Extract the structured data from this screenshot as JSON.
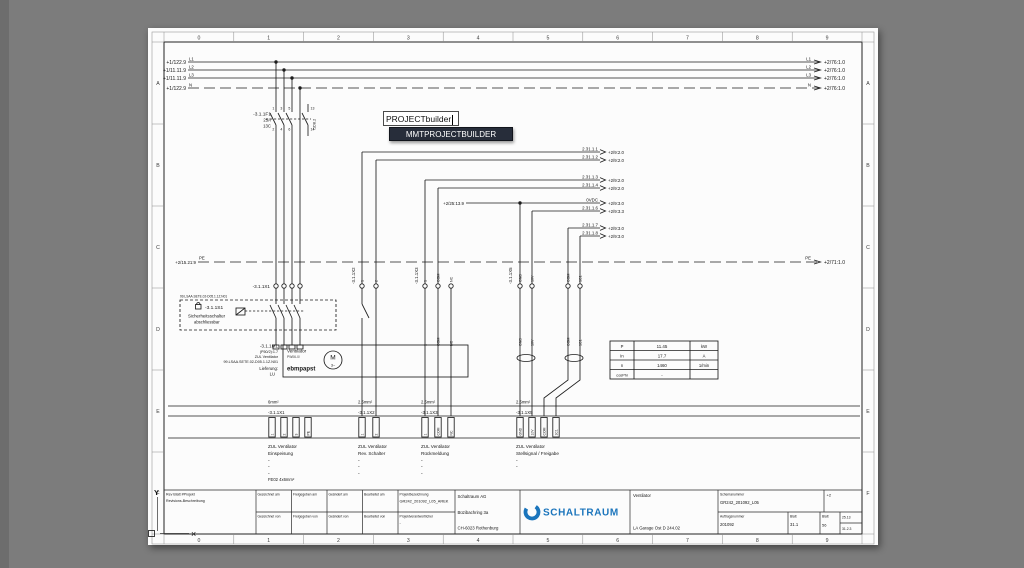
{
  "overlay": {
    "input": "PROJECTbuilder",
    "dropdown": "MMTPROJECTBUILDER"
  },
  "frame": {
    "cols": [
      "0",
      "1",
      "2",
      "3",
      "4",
      "5",
      "6",
      "7",
      "8",
      "9"
    ],
    "rows": [
      "A",
      "B",
      "C",
      "D",
      "E",
      "F"
    ]
  },
  "buses": {
    "rows": [
      {
        "left": "+1/122.9",
        "name": "L1",
        "ref": "+2/76:1.0"
      },
      {
        "left": "+1/11.11.9",
        "name": "L2",
        "ref": "+2/76:1.0"
      },
      {
        "left": "+1/11.11.9",
        "name": "L3",
        "ref": "+2/76:1.0"
      },
      {
        "left": "+1/122.9",
        "name": "N",
        "ref": "+2/76:1.0"
      }
    ]
  },
  "pe": {
    "left": "+2/15.21:9",
    "name": "PE",
    "right": "+2/71:1.0"
  },
  "breaker": {
    "tag": "-3.1.1F1",
    "rating": "25A",
    "curve": "13C",
    "aux_ref": "/1D8.2",
    "pins": [
      "1",
      "3",
      "5",
      "2",
      "4",
      "6",
      "13",
      "14"
    ]
  },
  "wires": [
    {
      "label": "2.31.1.1",
      "ref": "+2/9:2.0"
    },
    {
      "label": "2.31.1.2",
      "ref": "+2/9:2.0"
    },
    {
      "label": "2.31.1.3",
      "ref": "+2/9:2.0"
    },
    {
      "label": "2.31.1.4",
      "ref": "+2/9:2.0"
    },
    {
      "label": "0VDC",
      "ref": "+2/9:3.0",
      "left_ref": "+2/25:13.9"
    },
    {
      "label": "2.31.1.6",
      "ref": "+2/9:3.3"
    },
    {
      "label": "2.31.1.7",
      "ref": "+2/9:3.0"
    },
    {
      "label": "2.31.1.8",
      "ref": "+2/9:3.0"
    }
  ],
  "s1": {
    "tag": "-3.1.1S1",
    "name": "Sicherheitsschalter",
    "note": "abschliessbar",
    "code": "99.LSAA.SETE.02-D05.1.1Z.N01"
  },
  "m1": {
    "tag": "-3.1.1M1",
    "l1": "(P50/2):1.7",
    "l2": "ZUL Ventilator",
    "l3": "99.LSAA.SETE.02-D05.1.1Z.N01",
    "l4": "Lieferung:",
    "l5": "LU"
  },
  "motor": {
    "title": "Ventilator",
    "type": "PW06-0/",
    "brand": "ebmpapst",
    "sym": "M",
    "phase": "3~"
  },
  "table": {
    "rows": [
      [
        "P",
        "11.45",
        "kW"
      ],
      [
        "In",
        "17.7",
        "A"
      ],
      [
        "n",
        "1460",
        "1/min"
      ],
      [
        "cosPhi",
        "-",
        ""
      ]
    ]
  },
  "strip": {
    "dash": "-",
    "groups": [
      {
        "size": "6mm²",
        "tag": "-3.1.1X1",
        "pins": [
          "1",
          "2",
          "3",
          "PE"
        ],
        "desc1": "ZUL Ventilator",
        "desc2": "Einspeisung",
        "extra": "FE02 4x6mm²"
      },
      {
        "size": "2.5mm²",
        "tag": "-3.1.1X2",
        "pins": [
          "1",
          "2"
        ],
        "desc1": "ZUL Ventilator",
        "desc2": "Rev. Schalter"
      },
      {
        "size": "2.5mm²",
        "tag": "-3.1.1X3",
        "pins": [
          "1",
          "COM",
          "NC"
        ],
        "desc1": "ZUL Ventilator",
        "desc2": "Rückmeldung"
      },
      {
        "size": "2.5mm²",
        "tag": "-3.1.1X5",
        "pins": [
          "GND",
          "10V",
          "COM",
          "1C1"
        ],
        "desc1": "ZUL Ventilator",
        "desc2": "Stellsignal / Freigabe"
      }
    ]
  },
  "titleblock": {
    "rev_header": "Rev  Blatt  #Projekt",
    "rev_label": "Revisions-Beschreibung",
    "row1": [
      "Gezeichnet am",
      "Freigegeben am",
      "Geändert am",
      "Bearbeitet am"
    ],
    "row2": [
      "Gezeichnet von",
      "Freigegeben von",
      "Geändert von",
      "Bearbeitet von"
    ],
    "project_label": "Projektbezeichnung",
    "project_value": "GR242_201092_L05_AREK",
    "manager_label": "Projektverantwortlicher",
    "manager_value": "-",
    "company": [
      "Schaltraum AG",
      "Büzibachring 3a",
      "CH-6023 Rothenburg"
    ],
    "brand": "SCHALTRAUM",
    "doc_title": "Ventilator",
    "doc_subtitle": "LA Garage Ost D 244.02",
    "schema_label": "Schemanummer",
    "schema_value": "GR242_201092_L05",
    "rev_mark": "+2",
    "order_label": "Auftragsnummer",
    "order_value": "201092",
    "sheet_label": "Blatt",
    "sheet_value": "31.1",
    "sheet2_label": "Blatt",
    "sheet2_value": "56",
    "extra1": "25.13",
    "extra2": "31.2.3"
  },
  "ucs": {
    "y": "Y",
    "x": "×"
  },
  "colors": {
    "brand_blue": "#1b75bc"
  }
}
